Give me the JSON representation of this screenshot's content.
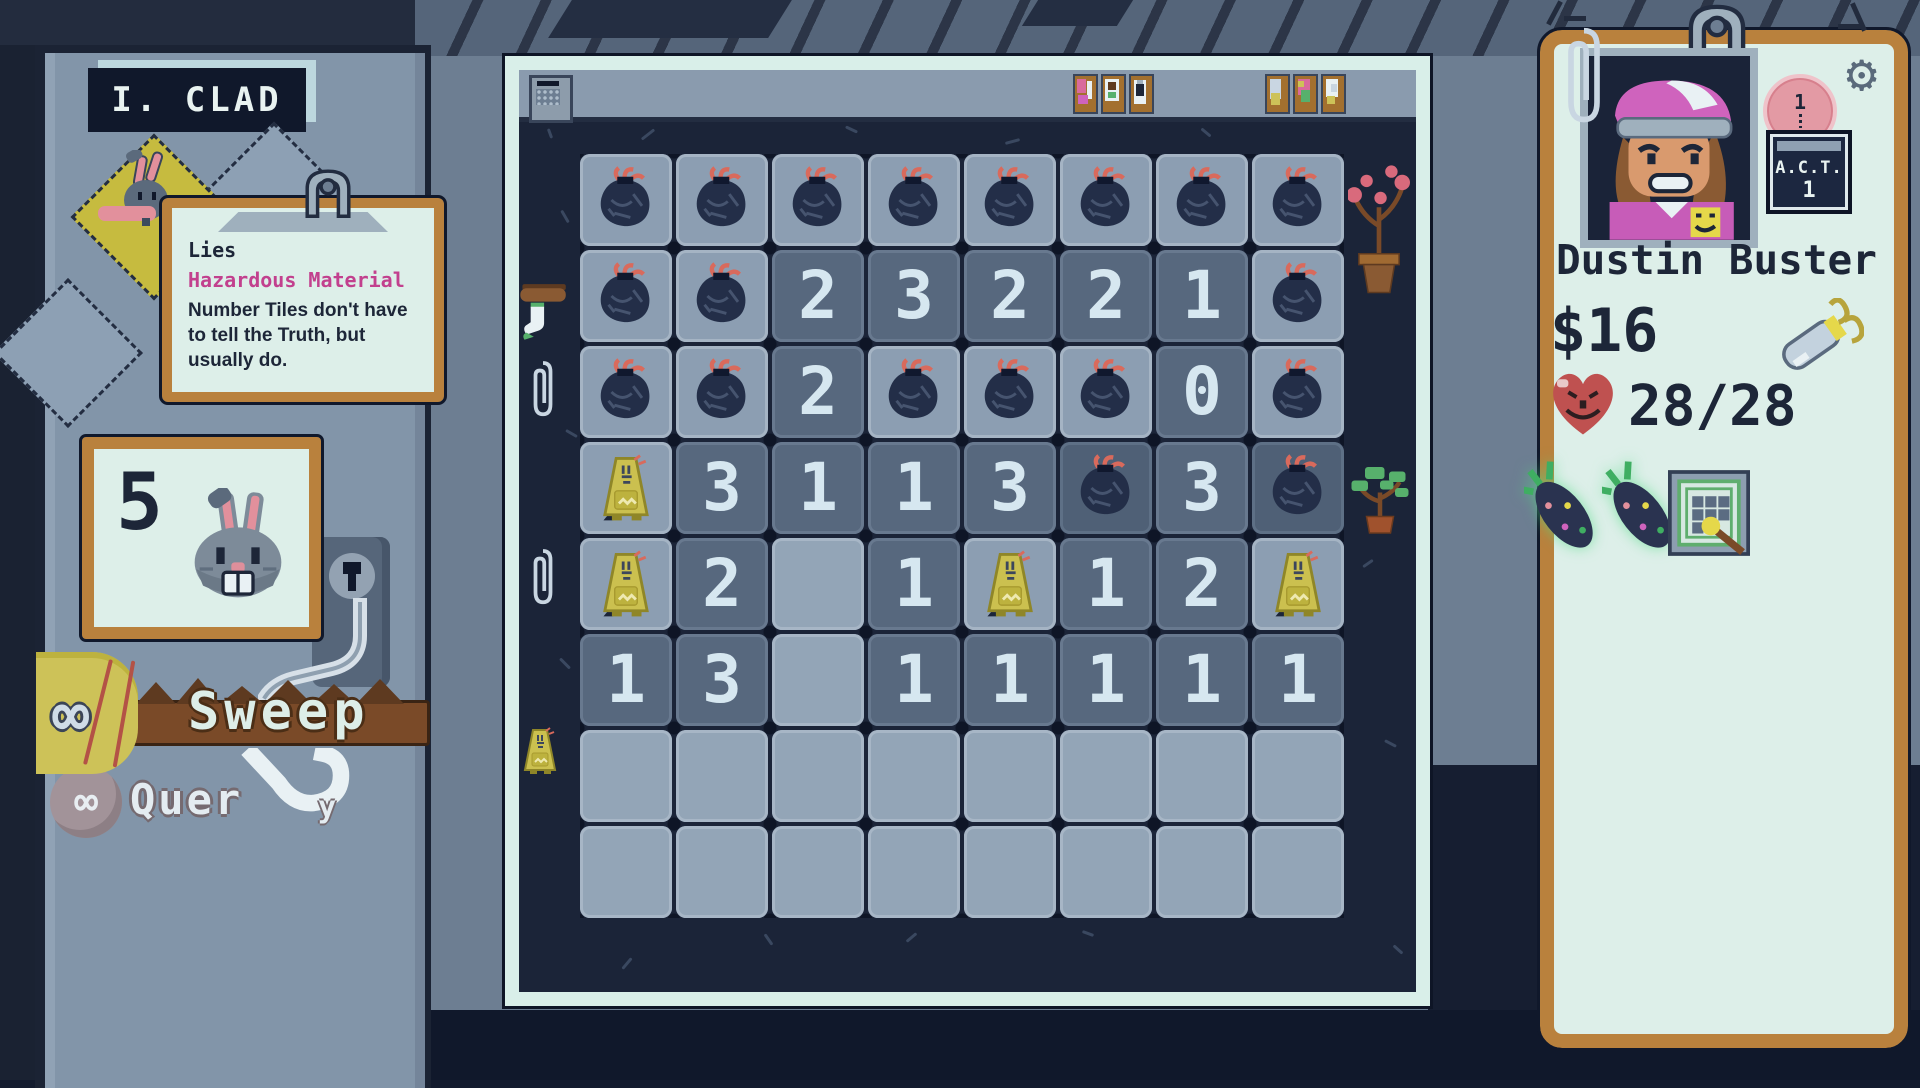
{
  "left_panel": {
    "sign_title": "I. CLAD",
    "tooltip": {
      "title": "Lies",
      "subtitle": "Hazardous Material",
      "body": "Number Tiles don't have to tell the Truth, but usually do."
    },
    "counter_value": "5",
    "actions": {
      "sweep": "Sweep",
      "query_prefix": "Quer",
      "query_suffix": "y"
    }
  },
  "board": {
    "grid": [
      [
        "B",
        "B",
        "B",
        "B",
        "B",
        "B",
        "B",
        "B"
      ],
      [
        "B",
        "B",
        "2",
        "3",
        "2",
        "2",
        "1",
        "B"
      ],
      [
        "B",
        "B",
        "2",
        "B",
        "B",
        "B",
        "0",
        "B"
      ],
      [
        "S",
        "3",
        "1",
        "1",
        "3",
        "D",
        "3",
        "D"
      ],
      [
        "S",
        "2",
        ".",
        "1",
        "S",
        "1",
        "2",
        "S"
      ],
      [
        "1",
        "3",
        ".",
        "1",
        "1",
        "1",
        "1",
        "1"
      ],
      [
        ".",
        ".",
        ".",
        ".",
        ".",
        ".",
        ".",
        "."
      ],
      [
        ".",
        ".",
        ".",
        ".",
        ".",
        ".",
        ".",
        "."
      ]
    ]
  },
  "right_panel": {
    "name": "Dustin Buster",
    "money": "$16",
    "health": "28/28",
    "act": {
      "label": "A.C.T.",
      "value": "1"
    },
    "pin_value": "1"
  },
  "icons": {
    "gear": "⚙",
    "infinity": "∞"
  },
  "colors": {
    "accent_magenta": "#c2408e",
    "paper": "#ddefe9",
    "frame_tan": "#b9813d",
    "tile_light": "#8c9eb2",
    "tile_dark": "#57687e",
    "heart_red": "#bf5150"
  }
}
